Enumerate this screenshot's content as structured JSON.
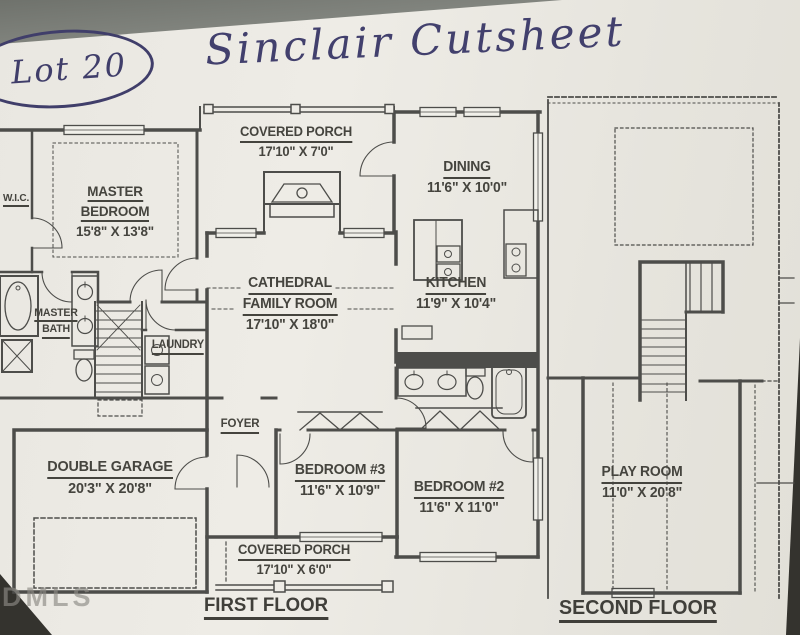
{
  "photo": {
    "background_color": "#34332e",
    "table_color": "#8b8e88",
    "paper_color": "#ebe9e3",
    "watermark": "DMLS"
  },
  "handwriting": {
    "ink_color": "#42406d",
    "lot_label": "Lot 20",
    "title": "Sinclair Cutsheet"
  },
  "plan": {
    "wall_color": "#4d4d4a",
    "text_color": "#45443e",
    "first_floor": {
      "label": "FIRST FLOOR",
      "rooms": {
        "wic": {
          "lines": [
            "W.I.C."
          ]
        },
        "master_bedroom": {
          "lines": [
            "MASTER",
            "BEDROOM"
          ],
          "dims": "15'8\" X 13'8\""
        },
        "covered_porch_top": {
          "lines": [
            "COVERED PORCH"
          ],
          "dims": "17'10\" X 7'0\""
        },
        "dining": {
          "lines": [
            "DINING"
          ],
          "dims": "11'6\" X 10'0\""
        },
        "family_room": {
          "lines": [
            "CATHEDRAL",
            "FAMILY ROOM"
          ],
          "dims": "17'10\" X 18'0\""
        },
        "kitchen": {
          "lines": [
            "KITCHEN"
          ],
          "dims": "11'9\" X 10'4\""
        },
        "master_bath": {
          "lines": [
            "MASTER",
            "BATH"
          ]
        },
        "laundry": {
          "lines": [
            "LAUNDRY"
          ]
        },
        "foyer": {
          "lines": [
            "FOYER"
          ]
        },
        "garage": {
          "lines": [
            "DOUBLE GARAGE"
          ],
          "dims": "20'3\" X 20'8\""
        },
        "bedroom3": {
          "lines": [
            "BEDROOM #3"
          ],
          "dims": "11'6\" X 10'9\""
        },
        "bedroom2": {
          "lines": [
            "BEDROOM #2"
          ],
          "dims": "11'6\" X 11'0\""
        },
        "covered_porch_bottom": {
          "lines": [
            "COVERED PORCH"
          ],
          "dims": "17'10\" X 6'0\""
        }
      }
    },
    "second_floor": {
      "label": "SECOND FLOOR",
      "rooms": {
        "playroom": {
          "lines": [
            "PLAY ROOM"
          ],
          "dims": "11'0\" X 20'8\""
        }
      }
    }
  }
}
